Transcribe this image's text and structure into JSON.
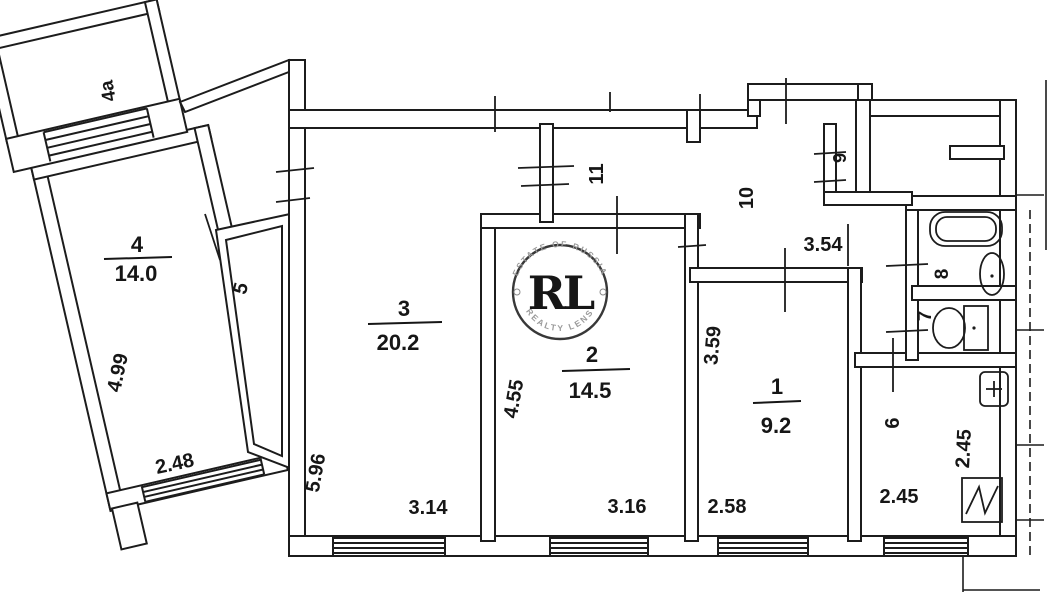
{
  "plan": {
    "type": "apartment-floor-plan",
    "rooms": [
      {
        "number": "4a",
        "area": ""
      },
      {
        "number": "4",
        "area": "14.0"
      },
      {
        "number": "5",
        "area": ""
      },
      {
        "number": "3",
        "area": "20.2"
      },
      {
        "number": "2",
        "area": "14.5"
      },
      {
        "number": "1",
        "area": "9.2"
      },
      {
        "number": "6",
        "area": ""
      },
      {
        "number": "7",
        "area": ""
      },
      {
        "number": "8",
        "area": ""
      },
      {
        "number": "9",
        "area": ""
      },
      {
        "number": "10",
        "area": ""
      },
      {
        "number": "11",
        "area": ""
      }
    ],
    "dimensions": [
      {
        "value": "4.99",
        "room": "4",
        "orientation": "vertical"
      },
      {
        "value": "2.48",
        "room": "4",
        "orientation": "horizontal"
      },
      {
        "value": "5.96",
        "room": "3",
        "orientation": "vertical"
      },
      {
        "value": "3.14",
        "room": "3",
        "orientation": "horizontal"
      },
      {
        "value": "4.55",
        "room": "2",
        "orientation": "vertical"
      },
      {
        "value": "3.16",
        "room": "2",
        "orientation": "horizontal"
      },
      {
        "value": "3.59",
        "room": "1",
        "orientation": "vertical"
      },
      {
        "value": "2.58",
        "room": "1",
        "orientation": "horizontal"
      },
      {
        "value": "3.54",
        "room": "10",
        "orientation": "horizontal"
      },
      {
        "value": "2.45",
        "room": "6",
        "orientation": "vertical"
      },
      {
        "value": "2.45",
        "room": "6",
        "orientation": "horizontal"
      }
    ],
    "watermark": {
      "initials": "RL",
      "arc_top": "ESTATE OF RUSSIA",
      "arc_bottom": "REALTY LENS"
    },
    "colors": {
      "line": "#1c1c1c",
      "background": "#ffffff",
      "gold": "#bf9b3a",
      "watermark_ring": "#383838",
      "watermark_text": "#9a9a9a"
    }
  }
}
